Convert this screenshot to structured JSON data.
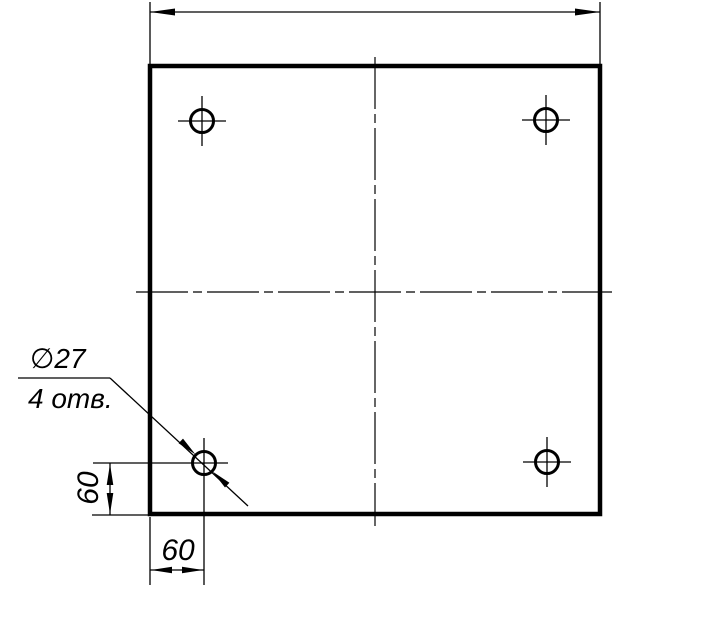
{
  "drawing": {
    "kind": "engineering-drawing",
    "colors": {
      "line": "#000000",
      "background": "#ffffff"
    },
    "annotations": {
      "hole_diameter_label": "∅27",
      "hole_count_label": "4 отв.",
      "vertical_offset_dim": "60",
      "horizontal_offset_dim": "60"
    }
  }
}
